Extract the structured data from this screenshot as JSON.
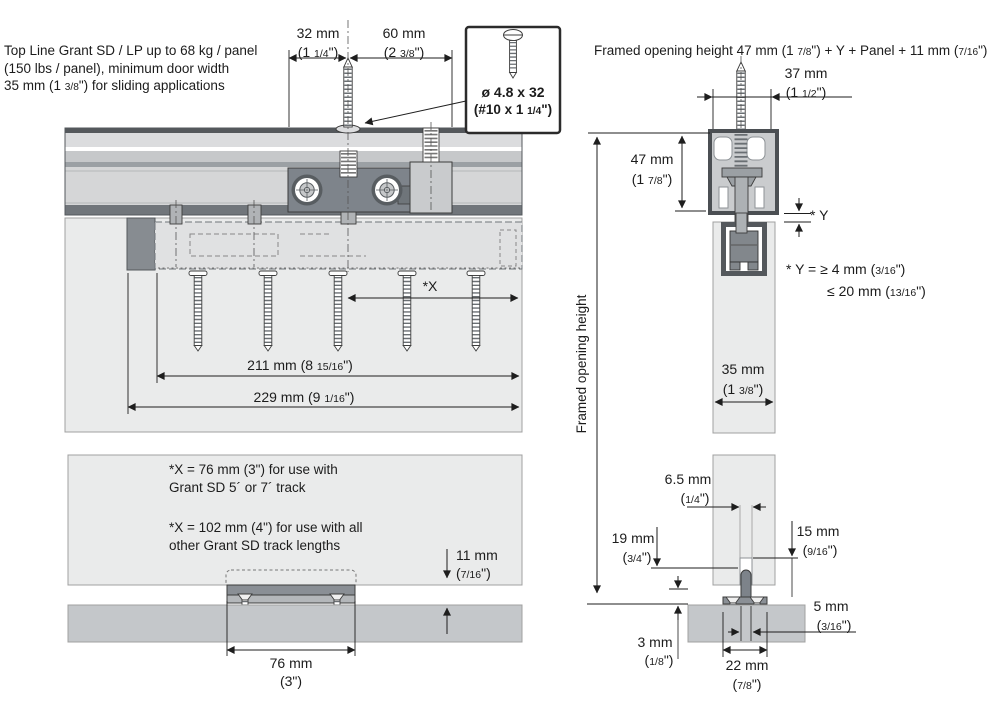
{
  "intro_note": "Top Line Grant SD / LP up to 68 kg / panel\n(150 lbs / panel), minimum door width\n35 mm (1 3/8\") for sliding applications",
  "left_figure": {
    "dim_32": {
      "mm": "32 mm",
      "inch": "(1 1/4\")"
    },
    "dim_60": {
      "mm": "60 mm",
      "inch": "(2 3/8\")"
    },
    "screw_spec": {
      "metric": "ø 4.8 x 32",
      "imperial": "(#10 x 1 1/4\")"
    },
    "dim_x": "*X",
    "dim_211": "211 mm (8 15/16\")",
    "dim_229": "229 mm (9 1/16\")",
    "note_x76": "*X = 76 mm (3\") for use with\nGrant SD 5´ or 7´ track",
    "note_x102": "*X = 102 mm (4\") for use with all\nother Grant SD track lengths",
    "dim_11": {
      "mm": "11 mm",
      "inch": "(7/16\")"
    },
    "dim_76": {
      "mm": "76 mm",
      "inch": "(3\")"
    }
  },
  "right_figure": {
    "formula": "Framed opening height 47 mm (1 7/8\") + Y + Panel + 11 mm (7/16\")",
    "dim_37": {
      "mm": "37 mm",
      "inch": "(1 1/2\")"
    },
    "dim_47": {
      "mm": "47 mm",
      "inch": "(1 7/8\")"
    },
    "y_label": "* Y",
    "y_note_line1": "* Y = ≥ 4 mm (3/16\")",
    "y_note_line2": "≤ 20 mm (13/16\")",
    "axis_label": "Framed opening height",
    "dim_35": {
      "mm": "35 mm",
      "inch": "(1 3/8\")"
    },
    "dim_6_5": {
      "mm": "6.5 mm",
      "inch": "(1/4\")"
    },
    "dim_19": {
      "mm": "19 mm",
      "inch": "(3/4\")"
    },
    "dim_15": {
      "mm": "15 mm",
      "inch": "(9/16\")"
    },
    "dim_5": {
      "mm": "5 mm",
      "inch": "(3/16\")"
    },
    "dim_3": {
      "mm": "3 mm",
      "inch": "(1/8\")"
    },
    "dim_22": {
      "mm": "22 mm",
      "inch": "(7/8\")"
    }
  }
}
